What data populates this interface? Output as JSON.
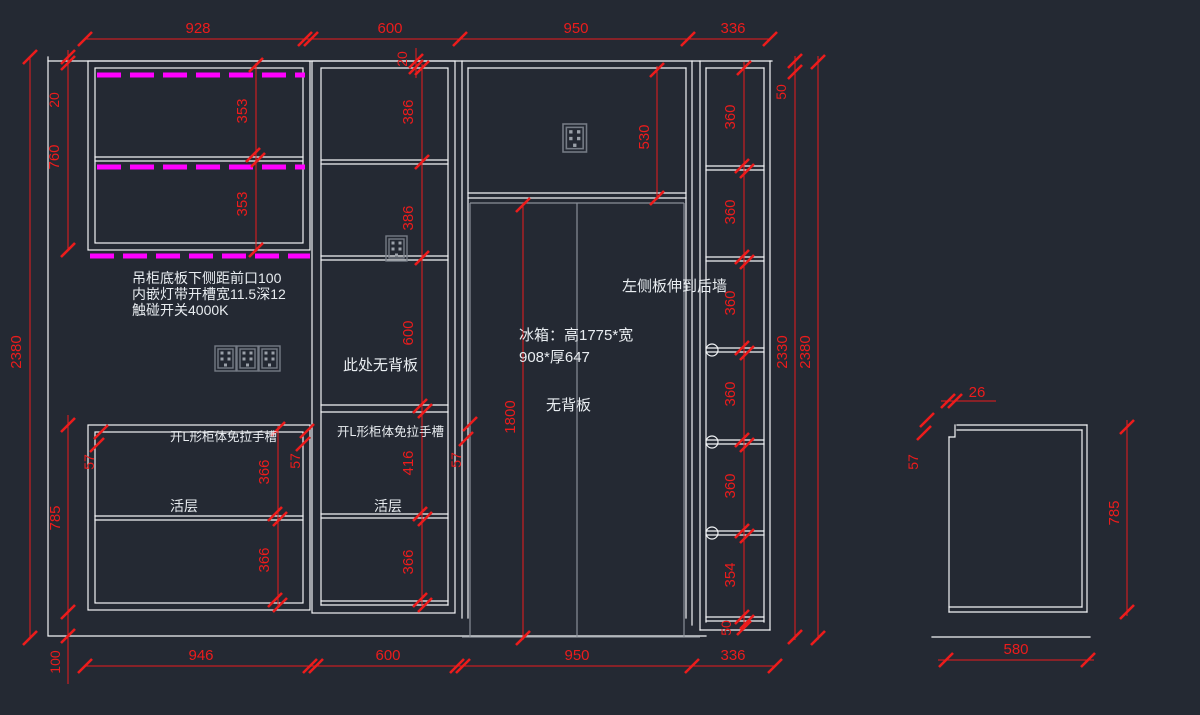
{
  "canvas": {
    "background": "#242933",
    "line_color": "#f2f4f6",
    "dimension_color": "#ec1c1c",
    "led_color": "#ff00ff",
    "appliance_color": "#8a9099"
  },
  "dimensions": {
    "top_row": [
      "928",
      "600",
      "950",
      "336"
    ],
    "bottom_row": [
      "946",
      "600",
      "950",
      "336"
    ],
    "overall_height": "2380",
    "interior_height": "2330",
    "top_reveal": "50",
    "wall_gap": "20",
    "hanging_cabinet_height": "760",
    "hanging_shelf": "353",
    "base_cabinet_height": "785",
    "base_shelf": "366",
    "toe_kick": "100",
    "edge_reveal": "57",
    "mid_shelf": "386",
    "mid_open_height": "600",
    "mid_lower": "416",
    "fridge_top_section": "530",
    "fridge_opening": "1800",
    "right_shelf": "360",
    "right_shelf_last": "354",
    "right_base": "50",
    "side_notch": "26",
    "side_height": "785",
    "side_depth": "580"
  },
  "annotations": {
    "led_note_1": "吊柜底板下侧距前口100",
    "led_note_2": "内嵌灯带开槽宽11.5深12",
    "led_note_3": "触碰开关4000K",
    "no_back_here": "此处无背板",
    "l_groove": "开L形柜体免拉手槽",
    "shelf": "活层",
    "fridge_spec_1": "冰箱：高1775*宽",
    "fridge_spec_2": "908*厚647",
    "no_back": "无背板",
    "left_panel": "左侧板伸到后墙"
  }
}
